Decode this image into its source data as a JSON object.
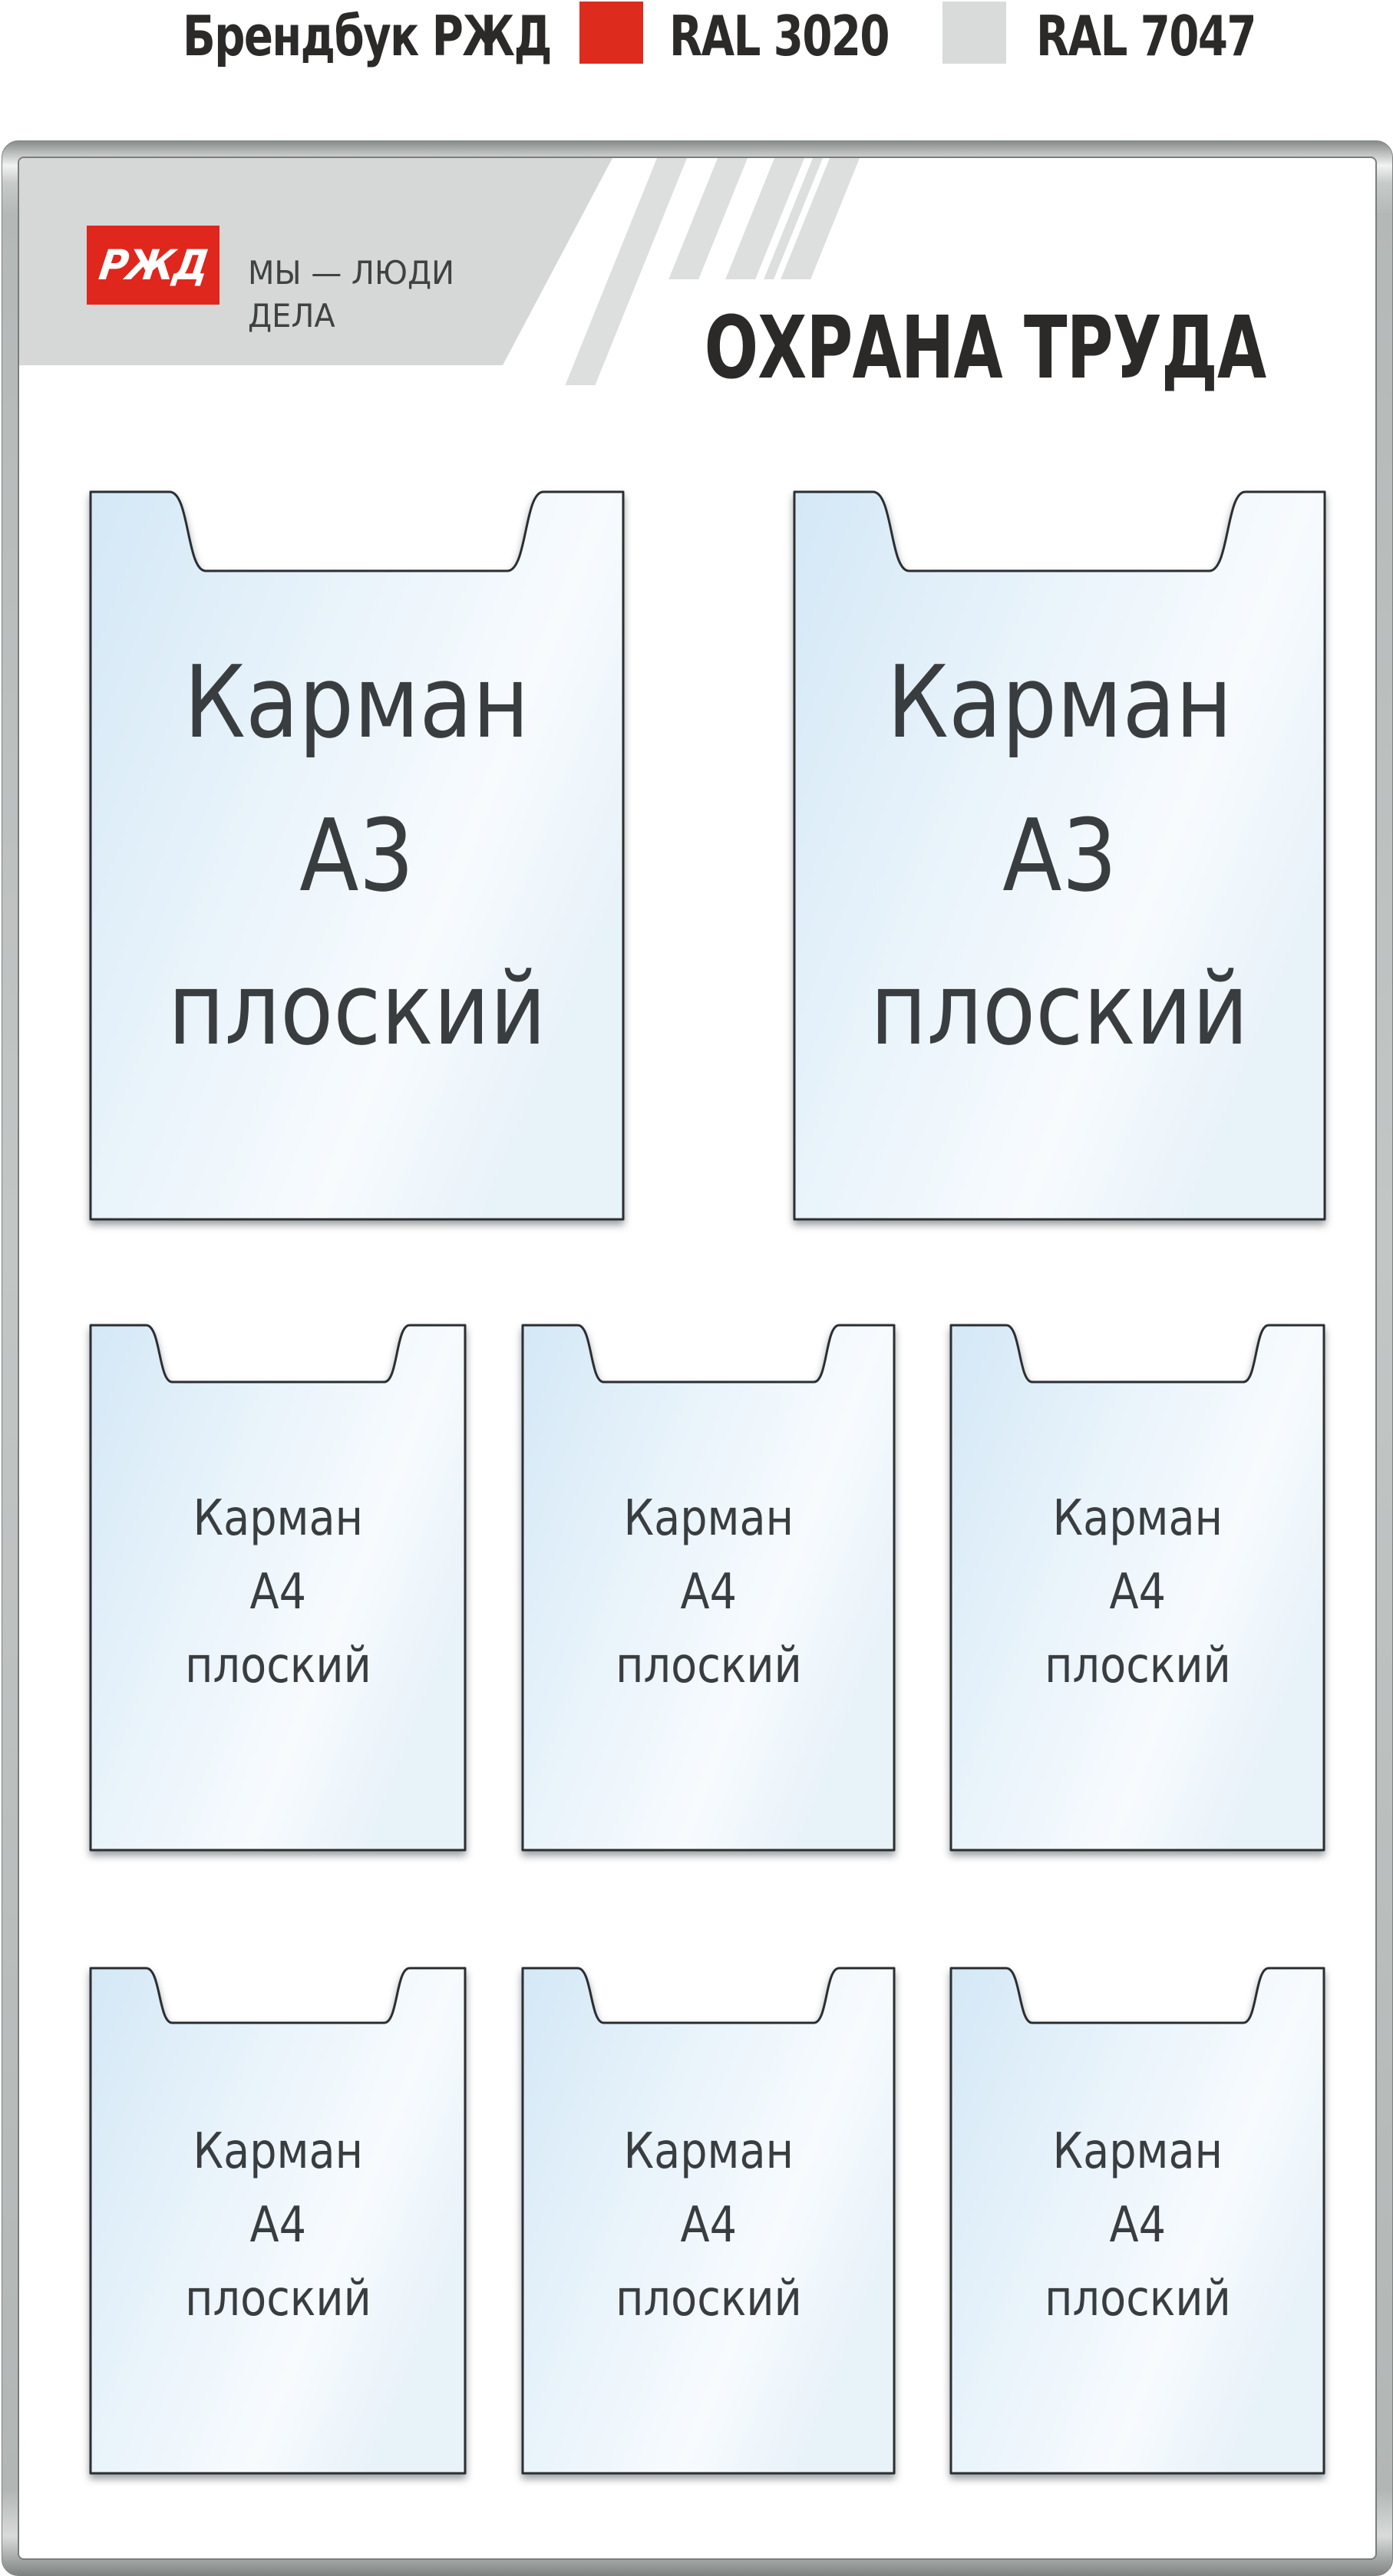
{
  "header": {
    "brand": "Брендбук РЖД",
    "ral_red_label": "RAL 3020",
    "ral_gray_label": "RAL 7047"
  },
  "board": {
    "logo_text": "РЖД",
    "slogan_line1": "МЫ — ЛЮДИ",
    "slogan_line2": "ДЕЛА",
    "title": "ОХРАНА ТРУДА"
  },
  "pockets": {
    "a3": [
      {
        "line1": "Карман",
        "line2": "А3",
        "line3": "плоский"
      },
      {
        "line1": "Карман",
        "line2": "А3",
        "line3": "плоский"
      }
    ],
    "a4": [
      {
        "line1": "Карман",
        "line2": "А4",
        "line3": "плоский"
      },
      {
        "line1": "Карман",
        "line2": "А4",
        "line3": "плоский"
      },
      {
        "line1": "Карман",
        "line2": "А4",
        "line3": "плоский"
      },
      {
        "line1": "Карман",
        "line2": "А4",
        "line3": "плоский"
      },
      {
        "line1": "Карман",
        "line2": "А4",
        "line3": "плоский"
      },
      {
        "line1": "Карман",
        "line2": "А4",
        "line3": "плоский"
      }
    ]
  },
  "colors": {
    "accent_red": "#dd2b1e",
    "swatch_gray": "#d9dbda",
    "band_gray": "#d5d8d7",
    "stripe_gray": "#dcdfde",
    "pocket_blue": "#d4e8f6",
    "title_dark": "#2b2a29"
  }
}
